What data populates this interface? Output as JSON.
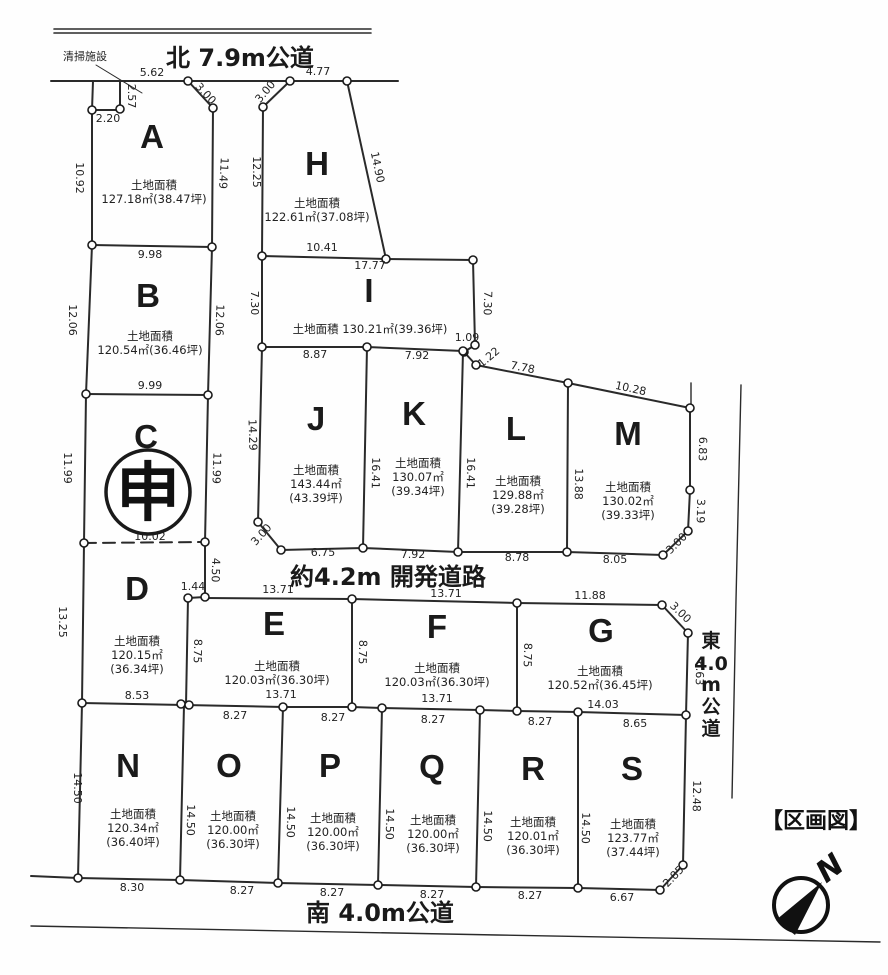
{
  "legend": {
    "title": "【区画図】"
  },
  "compass": {
    "letter": "N"
  },
  "annotations": {
    "facility": "清掃施設"
  },
  "roads": {
    "north": "北 7.9m公道",
    "south": "南 4.0m公道",
    "dev": "約4.2m 開発道路",
    "east": {
      "text": "東4.0m公道",
      "stack": [
        "東",
        "4.0",
        "m",
        "公",
        "道"
      ]
    }
  },
  "special_mark": {
    "character": "申",
    "plot": "C"
  },
  "plots": [
    {
      "id": "A",
      "lx": 152,
      "ly": 148,
      "ax": 154,
      "ay": 189,
      "area": [
        "土地面積",
        "127.18㎡(38.47坪)"
      ]
    },
    {
      "id": "B",
      "lx": 148,
      "ly": 307,
      "ax": 150,
      "ay": 340,
      "area": [
        "土地面積",
        "120.54㎡(36.46坪)"
      ]
    },
    {
      "id": "C",
      "lx": 146,
      "ly": 448,
      "ax": 148,
      "ay": 0,
      "area": []
    },
    {
      "id": "D",
      "lx": 137,
      "ly": 600,
      "ax": 137,
      "ay": 645,
      "area": [
        "土地面積",
        "120.15㎡",
        "(36.34坪)"
      ]
    },
    {
      "id": "E",
      "lx": 274,
      "ly": 635,
      "ax": 277,
      "ay": 670,
      "area": [
        "土地面積",
        "120.03㎡(36.30坪)"
      ]
    },
    {
      "id": "F",
      "lx": 437,
      "ly": 638,
      "ax": 437,
      "ay": 672,
      "area": [
        "土地面積",
        "120.03㎡(36.30坪)"
      ]
    },
    {
      "id": "G",
      "lx": 601,
      "ly": 642,
      "ax": 600,
      "ay": 675,
      "area": [
        "土地面積",
        "120.52㎡(36.45坪)"
      ]
    },
    {
      "id": "H",
      "lx": 317,
      "ly": 175,
      "ax": 317,
      "ay": 207,
      "area": [
        "土地面積",
        "122.61㎡(37.08坪)"
      ]
    },
    {
      "id": "I",
      "lx": 369,
      "ly": 302,
      "ax": 370,
      "ay": 333,
      "area": [
        "土地面積 130.21㎡(39.36坪)"
      ]
    },
    {
      "id": "J",
      "lx": 316,
      "ly": 430,
      "ax": 316,
      "ay": 474,
      "area": [
        "土地面積",
        "143.44㎡",
        "(43.39坪)"
      ]
    },
    {
      "id": "K",
      "lx": 414,
      "ly": 425,
      "ax": 418,
      "ay": 467,
      "area": [
        "土地面積",
        "130.07㎡",
        "(39.34坪)"
      ]
    },
    {
      "id": "L",
      "lx": 516,
      "ly": 440,
      "ax": 518,
      "ay": 485,
      "area": [
        "土地面積",
        "129.88㎡",
        "(39.28坪)"
      ]
    },
    {
      "id": "M",
      "lx": 628,
      "ly": 445,
      "ax": 628,
      "ay": 491,
      "area": [
        "土地面積",
        "130.02㎡",
        "(39.33坪)"
      ]
    },
    {
      "id": "N",
      "lx": 128,
      "ly": 777,
      "ax": 133,
      "ay": 818,
      "area": [
        "土地面積",
        "120.34㎡",
        "(36.40坪)"
      ]
    },
    {
      "id": "O",
      "lx": 229,
      "ly": 777,
      "ax": 233,
      "ay": 820,
      "area": [
        "土地面積",
        "120.00㎡",
        "(36.30坪)"
      ]
    },
    {
      "id": "P",
      "lx": 330,
      "ly": 777,
      "ax": 333,
      "ay": 822,
      "area": [
        "土地面積",
        "120.00㎡",
        "(36.30坪)"
      ]
    },
    {
      "id": "Q",
      "lx": 432,
      "ly": 778,
      "ax": 433,
      "ay": 824,
      "area": [
        "土地面積",
        "120.00㎡",
        "(36.30坪)"
      ]
    },
    {
      "id": "R",
      "lx": 533,
      "ly": 780,
      "ax": 533,
      "ay": 826,
      "area": [
        "土地面積",
        "120.01㎡",
        "(36.30坪)"
      ]
    },
    {
      "id": "S",
      "lx": 632,
      "ly": 780,
      "ax": 633,
      "ay": 828,
      "area": [
        "土地面積",
        "123.77㎡",
        "(37.44坪)"
      ]
    }
  ],
  "dimensions": [
    {
      "t": "5.62",
      "x": 152,
      "y": 76,
      "r": 0
    },
    {
      "t": "3.00",
      "x": 203,
      "y": 96,
      "r": 47
    },
    {
      "t": "2.57",
      "x": 128,
      "y": 96,
      "r": 90
    },
    {
      "t": "2.20",
      "x": 108,
      "y": 122,
      "r": 0
    },
    {
      "t": "10.92",
      "x": 76,
      "y": 178,
      "r": 90
    },
    {
      "t": "11.49",
      "x": 220,
      "y": 173,
      "r": 93
    },
    {
      "t": "9.98",
      "x": 150,
      "y": 258,
      "r": 0
    },
    {
      "t": "12.06",
      "x": 69,
      "y": 320,
      "r": 90
    },
    {
      "t": "12.06",
      "x": 216,
      "y": 320,
      "r": 92
    },
    {
      "t": "9.99",
      "x": 150,
      "y": 389,
      "r": 0
    },
    {
      "t": "11.99",
      "x": 64,
      "y": 468,
      "r": 90
    },
    {
      "t": "11.99",
      "x": 213,
      "y": 468,
      "r": 92
    },
    {
      "t": "10.02",
      "x": 150,
      "y": 540,
      "r": 0
    },
    {
      "t": "13.25",
      "x": 59,
      "y": 622,
      "r": 90
    },
    {
      "t": "4.50",
      "x": 212,
      "y": 570,
      "r": 92
    },
    {
      "t": "1.44",
      "x": 193,
      "y": 590,
      "r": 0
    },
    {
      "t": "8.75",
      "x": 194,
      "y": 651,
      "r": 92
    },
    {
      "t": "8.53",
      "x": 137,
      "y": 699,
      "r": 0
    },
    {
      "t": "14.50",
      "x": 74,
      "y": 788,
      "r": 90
    },
    {
      "t": "8.30",
      "x": 132,
      "y": 891,
      "r": 0
    },
    {
      "t": "4.77",
      "x": 318,
      "y": 75,
      "r": 0
    },
    {
      "t": "3.00",
      "x": 268,
      "y": 94,
      "r": -50
    },
    {
      "t": "12.25",
      "x": 253,
      "y": 172,
      "r": 90
    },
    {
      "t": "14.90",
      "x": 374,
      "y": 168,
      "r": 78
    },
    {
      "t": "10.41",
      "x": 322,
      "y": 251,
      "r": 0
    },
    {
      "t": "17.77",
      "x": 370,
      "y": 269,
      "r": 0
    },
    {
      "t": "7.30",
      "x": 251,
      "y": 303,
      "r": 90
    },
    {
      "t": "7.30",
      "x": 484,
      "y": 303,
      "r": 92
    },
    {
      "t": "8.87",
      "x": 315,
      "y": 358,
      "r": 0
    },
    {
      "t": "7.92",
      "x": 417,
      "y": 359,
      "r": 0
    },
    {
      "t": "1.09",
      "x": 467,
      "y": 341,
      "r": 0
    },
    {
      "t": "1.22",
      "x": 491,
      "y": 360,
      "r": -40
    },
    {
      "t": "7.78",
      "x": 522,
      "y": 371,
      "r": 11
    },
    {
      "t": "10.28",
      "x": 630,
      "y": 392,
      "r": 12
    },
    {
      "t": "14.29",
      "x": 249,
      "y": 435,
      "r": 88
    },
    {
      "t": "16.41",
      "x": 372,
      "y": 473,
      "r": 91
    },
    {
      "t": "16.41",
      "x": 467,
      "y": 473,
      "r": 91
    },
    {
      "t": "13.88",
      "x": 575,
      "y": 484,
      "r": 91
    },
    {
      "t": "6.83",
      "x": 699,
      "y": 449,
      "r": 91
    },
    {
      "t": "3.19",
      "x": 697,
      "y": 511,
      "r": 91
    },
    {
      "t": "3.00",
      "x": 679,
      "y": 546,
      "r": -45
    },
    {
      "t": "3.00",
      "x": 264,
      "y": 537,
      "r": -48
    },
    {
      "t": "6.75",
      "x": 323,
      "y": 556,
      "r": 0
    },
    {
      "t": "7.92",
      "x": 413,
      "y": 558,
      "r": 0
    },
    {
      "t": "8.78",
      "x": 517,
      "y": 561,
      "r": 0
    },
    {
      "t": "8.05",
      "x": 615,
      "y": 563,
      "r": 0
    },
    {
      "t": "13.71",
      "x": 278,
      "y": 593,
      "r": 0
    },
    {
      "t": "13.71",
      "x": 446,
      "y": 597,
      "r": 0
    },
    {
      "t": "11.88",
      "x": 590,
      "y": 599,
      "r": 0
    },
    {
      "t": "3.00",
      "x": 678,
      "y": 615,
      "r": 44
    },
    {
      "t": "8.75",
      "x": 359,
      "y": 652,
      "r": 92
    },
    {
      "t": "8.75",
      "x": 524,
      "y": 655,
      "r": 92
    },
    {
      "t": "6.63",
      "x": 696,
      "y": 673,
      "r": 91
    },
    {
      "t": "13.71",
      "x": 281,
      "y": 698,
      "r": 0
    },
    {
      "t": "13.71",
      "x": 437,
      "y": 702,
      "r": 0
    },
    {
      "t": "14.03",
      "x": 603,
      "y": 708,
      "r": 0
    },
    {
      "t": "8.27",
      "x": 235,
      "y": 719,
      "r": 0
    },
    {
      "t": "8.27",
      "x": 333,
      "y": 721,
      "r": 0
    },
    {
      "t": "8.27",
      "x": 433,
      "y": 723,
      "r": 0
    },
    {
      "t": "8.27",
      "x": 540,
      "y": 725,
      "r": 0
    },
    {
      "t": "8.65",
      "x": 635,
      "y": 727,
      "r": 0
    },
    {
      "t": "14.50",
      "x": 187,
      "y": 820,
      "r": 91
    },
    {
      "t": "14.50",
      "x": 287,
      "y": 822,
      "r": 91
    },
    {
      "t": "14.50",
      "x": 386,
      "y": 824,
      "r": 91
    },
    {
      "t": "14.50",
      "x": 484,
      "y": 826,
      "r": 91
    },
    {
      "t": "14.50",
      "x": 582,
      "y": 828,
      "r": 91
    },
    {
      "t": "12.48",
      "x": 693,
      "y": 796,
      "r": 91
    },
    {
      "t": "2.85",
      "x": 676,
      "y": 879,
      "r": -46
    },
    {
      "t": "8.27",
      "x": 242,
      "y": 894,
      "r": 0
    },
    {
      "t": "8.27",
      "x": 332,
      "y": 896,
      "r": 0
    },
    {
      "t": "8.27",
      "x": 432,
      "y": 898,
      "r": 0
    },
    {
      "t": "8.27",
      "x": 530,
      "y": 899,
      "r": 0
    },
    {
      "t": "6.67",
      "x": 622,
      "y": 901,
      "r": 0
    }
  ]
}
